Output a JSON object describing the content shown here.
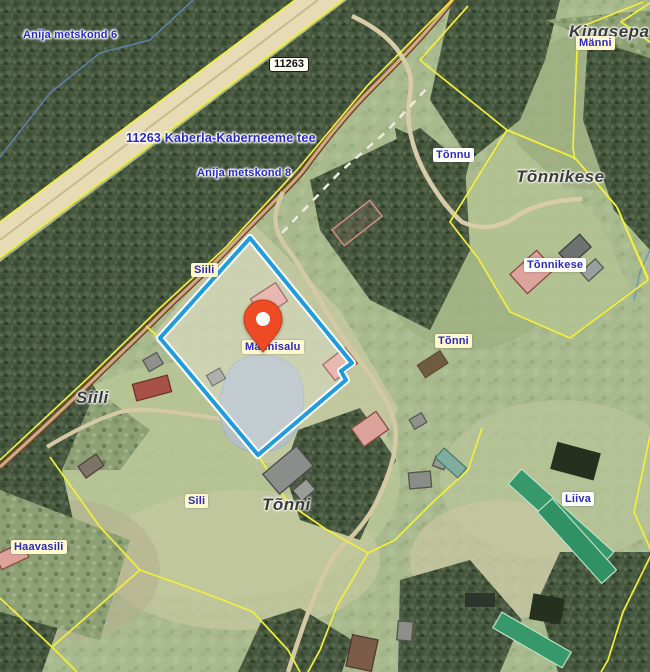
{
  "map": {
    "type": "satellite-cadastral-map",
    "marker": {
      "title": "Männisalu"
    },
    "road_badge": "11263",
    "labels": {
      "anija_metskond_6": "Anija metskond 6",
      "road_name": "11263 Kaberla-Kaberneeme tee",
      "anija_metskond_8": "Anija metskond 8",
      "kingsepa": "Kingsepa",
      "manni": "Männi",
      "tonnu": "Tõnnu",
      "tonnikese_place": "Tõnnikese",
      "tonnikese_farm": "Tõnnikese",
      "tonni_farm": "Tõnni",
      "siil": "Siili",
      "mannisalu": "Männisalu",
      "siili_place": "Siili",
      "sili": "Sili",
      "haavasili": "Haavasili",
      "tonni_place": "Tõnni",
      "liiva": "Liiva"
    },
    "colors": {
      "parcel_highlight": "#1f9ce0",
      "cadastral_line": "#f2ee3c",
      "marker": "#ee4a23",
      "label_blue": "#2a2ac2",
      "road_fill": "#e6dbb4",
      "pond": "#b3bfc3"
    }
  }
}
